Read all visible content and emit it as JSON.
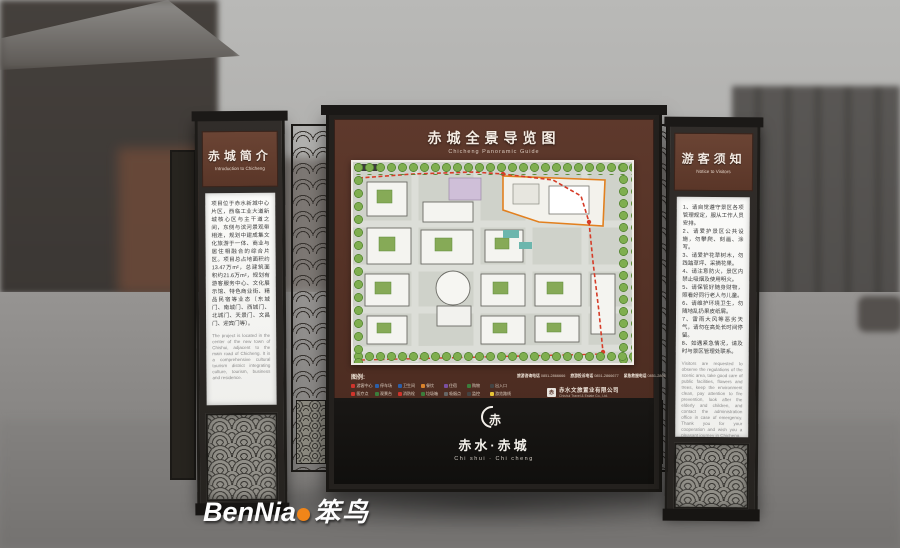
{
  "left_panel": {
    "title_cn": "赤城简介",
    "title_en": "Introduction to Chicheng",
    "body_cn": "项目位于赤水新城中心片区，西临工业大道新城核心区与主干道之间，东侧与滨河景观带相连，规划中建成集文化旅游于一体、商业与居住相融合的综合片区。项目总占地面积约13.47万m²，总建筑面积约21.6万m²，规划有游客服务中心、文化展示馆、特色商业街、精品民宿等业态（东城门、南城门、西城门、北城门、天景门、文昌门、迎宾门等）。",
    "body_en": "The project is located in the center of the new town of Chishui, adjacent to the main road of Chicheng. It is a comprehensive cultural tourism district integrating culture, tourism, business and residence."
  },
  "main_sign": {
    "title_cn": "赤城全景导览图",
    "title_en": "Chicheng Panoramic Guide",
    "legend": {
      "title": "图例:",
      "items": [
        {
          "label": "游客中心",
          "color": "#d0342c"
        },
        {
          "label": "停车场",
          "color": "#2c5fa8"
        },
        {
          "label": "卫生间",
          "color": "#2c5fa8"
        },
        {
          "label": "餐饮",
          "color": "#d9822b"
        },
        {
          "label": "住宿",
          "color": "#7a4fa0"
        },
        {
          "label": "购物",
          "color": "#3b7d3b"
        },
        {
          "label": "出入口",
          "color": "#444444"
        },
        {
          "label": "医疗点",
          "color": "#d0342c"
        },
        {
          "label": "观景台",
          "color": "#3b7d3b"
        },
        {
          "label": "消防栓",
          "color": "#d0342c"
        },
        {
          "label": "垃圾箱",
          "color": "#3b7d3b"
        },
        {
          "label": "吸烟点",
          "color": "#666666"
        },
        {
          "label": "监控",
          "color": "#444444"
        },
        {
          "label": "游览路线",
          "color": "#e8c437"
        }
      ]
    },
    "hotlines": [
      {
        "label": "旅游咨询电话",
        "number": "0851-2866666"
      },
      {
        "label": "旅游投诉电话",
        "number": "0851-2866677"
      },
      {
        "label": "紧急救援电话",
        "number": "0851-2866688"
      }
    ],
    "company_cn": "赤水文旅置业有限公司",
    "company_en": "Chishui Travel & Estate Co., Ltd.",
    "company_logo_glyph": "赤",
    "emblem_glyph": "赤",
    "logo_cn": "赤水·赤城",
    "logo_en": "Chi shui · Chi cheng"
  },
  "right_panel": {
    "title_cn": "游客须知",
    "title_en": "Notice to Visitors",
    "body_cn": "1、请自觉遵守景区各项管理规定，服从工作人员安排。\n2、请爱护景区公共设施，勿攀爬、刻画、涂写。\n3、请爱护花草树木，勿践踏草坪、采摘花果。\n4、请注意防火，景区内禁止吸烟及使用明火。\n5、请保管好随身财物，照看好同行老人与儿童。\n6、请维护环境卫生，勿随地乱扔果皮纸屑。\n7、雷雨大风等恶劣天气，请勿在高处长时间停留。\n8、如遇紧急情况，请及时与景区管理处联系。",
    "body_en": "Visitors are requested to observe the regulations of the scenic area, take good care of public facilities, flowers and trees, keep the environment clean, pay attention to fire prevention, look after the elderly and children, and contact the administration office in case of emergency. Thank you for your cooperation and wish you a pleasant journey in Chicheng."
  },
  "watermark": {
    "brand_latin": "BenNia",
    "brand_cn": "笨鸟"
  }
}
